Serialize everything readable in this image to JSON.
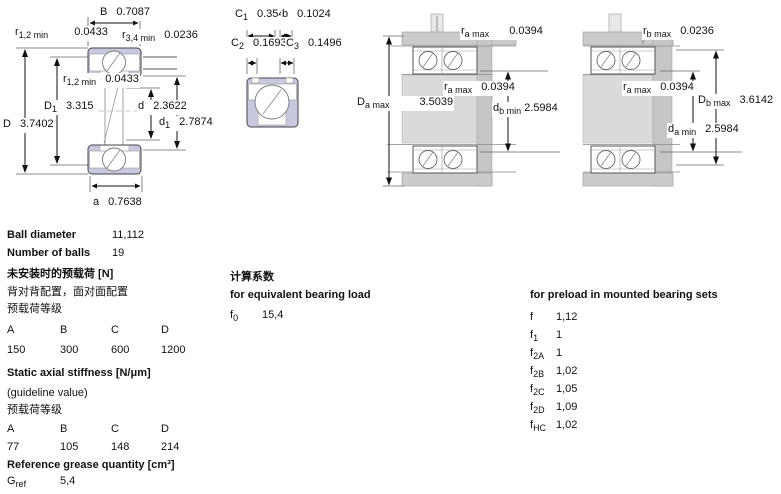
{
  "colors": {
    "ring_fill": "#c8c8e0",
    "housing_band": "#cbcbcb",
    "housing_center": "#dadada",
    "housing_column": "#c6c6c6",
    "outline": "#444444",
    "text": "#111111"
  },
  "drawings": {
    "single_bearing": {
      "labels": [
        {
          "base": "B",
          "sub": "",
          "value": "0.7087"
        },
        {
          "base": "r",
          "sub": "1,2 min",
          "value": "0.0433"
        },
        {
          "base": "r",
          "sub": "3,4 min",
          "value": "0.0236"
        },
        {
          "base": "r",
          "sub": "1,2 min",
          "value": "0.0433"
        },
        {
          "base": "D",
          "sub": "1",
          "value": "3.315"
        },
        {
          "base": "d",
          "sub": "",
          "value": "2.3622"
        },
        {
          "base": "D",
          "sub": "",
          "value": "3.7402"
        },
        {
          "base": "d",
          "sub": "1",
          "value": "2.7874"
        },
        {
          "base": "a",
          "sub": "",
          "value": "0.7638"
        }
      ]
    },
    "flange_detail": {
      "labels": [
        {
          "base": "C",
          "sub": "1",
          "value": "0.354"
        },
        {
          "base": "b",
          "sub": "",
          "value": "0.1024"
        },
        {
          "base": "C",
          "sub": "2",
          "value": "0.1693"
        },
        {
          "base": "C",
          "sub": "3",
          "value": "0.1496"
        }
      ]
    },
    "mounted_set_left": {
      "labels": [
        {
          "base": "r",
          "sub": "a max",
          "value": "0.0394"
        },
        {
          "base": "r",
          "sub": "a max",
          "value": "0.0394"
        },
        {
          "base": "D",
          "sub": "a max",
          "value": "3.5039"
        },
        {
          "base": "d",
          "sub": "b min",
          "value": "2.5984"
        }
      ]
    },
    "mounted_set_right": {
      "labels": [
        {
          "base": "r",
          "sub": "b max",
          "value": "0.0236"
        },
        {
          "base": "r",
          "sub": "a max",
          "value": "0.0394"
        },
        {
          "base": "D",
          "sub": "b max",
          "value": "3.6142"
        },
        {
          "base": "d",
          "sub": "a min",
          "value": "2.5984"
        }
      ]
    }
  },
  "specs": {
    "ball_diameter": {
      "label": "Ball diameter",
      "value": "11,112"
    },
    "number_of_balls": {
      "label": "Number of balls",
      "value": "19"
    },
    "preload_unmounted": {
      "title": "未安装时的预载荷 [N]",
      "subtitle": "背对背配置，面对面配置",
      "class_label": "预载荷等级",
      "classes": [
        "A",
        "B",
        "C",
        "D"
      ],
      "values": [
        "150",
        "300",
        "600",
        "1200"
      ]
    },
    "static_axial_stiffness": {
      "title": "Static axial stiffness [N/μm]",
      "note": "(guideline value)",
      "class_label": "预载荷等级",
      "classes": [
        "A",
        "B",
        "C",
        "D"
      ],
      "values": [
        "77",
        "105",
        "148",
        "214"
      ]
    },
    "grease": {
      "title": "Reference grease quantity [cm³]",
      "symbol_base": "G",
      "symbol_sub": "ref",
      "value": "5,4"
    },
    "calculation_factors": {
      "title": "计算系数",
      "equivalent_load": {
        "title": "for equivalent bearing load",
        "rows": [
          {
            "base": "f",
            "sub": "0",
            "value": "15,4"
          }
        ]
      },
      "preload_mounted": {
        "title": "for preload in mounted bearing sets",
        "rows": [
          {
            "base": "f",
            "sub": "",
            "value": "1,12"
          },
          {
            "base": "f",
            "sub": "1",
            "value": "1"
          },
          {
            "base": "f",
            "sub": "2A",
            "value": "1"
          },
          {
            "base": "f",
            "sub": "2B",
            "value": "1,02"
          },
          {
            "base": "f",
            "sub": "2C",
            "value": "1,05"
          },
          {
            "base": "f",
            "sub": "2D",
            "value": "1,09"
          },
          {
            "base": "f",
            "sub": "HC",
            "value": "1,02"
          }
        ]
      }
    }
  }
}
